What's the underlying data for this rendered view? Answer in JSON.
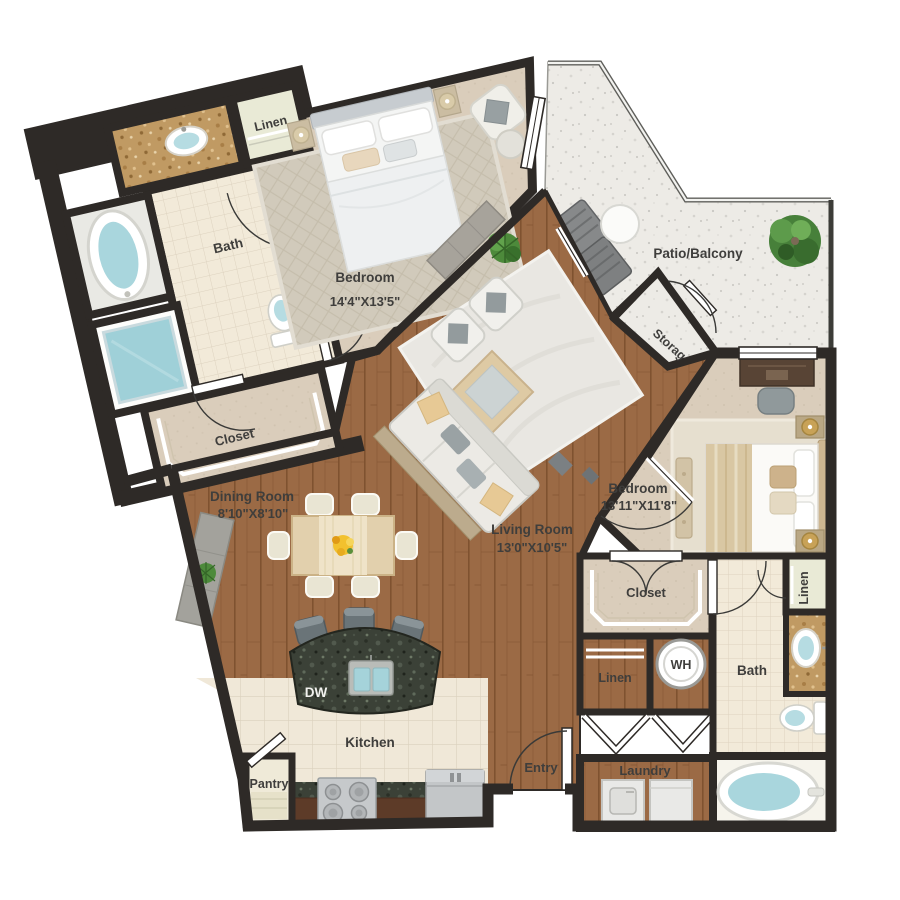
{
  "plan": {
    "title": "Two bedroom apartment floor plan",
    "rooms": {
      "bedroom1": {
        "name": "Bedroom",
        "dims": "14'4\"X13'5\""
      },
      "bedroom2": {
        "name": "Bedroom",
        "dims": "13'11\"X11'8\""
      },
      "living": {
        "name": "Living Room",
        "dims": "13'0\"X10'5\""
      },
      "dining": {
        "name": "Dining Room",
        "dims": "8'10\"X8'10\""
      },
      "kitchen": {
        "name": "Kitchen"
      },
      "bath1": {
        "name": "Bath"
      },
      "bath2": {
        "name": "Bath"
      },
      "closet1": {
        "name": "Closet"
      },
      "closet2": {
        "name": "Closet"
      },
      "linen1": {
        "name": "Linen"
      },
      "linen2": {
        "name": "Linen"
      },
      "linen3": {
        "name": "Linen"
      },
      "pantry": {
        "name": "Pantry"
      },
      "entry": {
        "name": "Entry"
      },
      "laundry": {
        "name": "Laundry"
      },
      "storage": {
        "name": "Storage"
      },
      "patio": {
        "name": "Patio/Balcony"
      }
    },
    "appliances": {
      "dishwasher": "DW",
      "water_heater": "WH"
    },
    "palette": {
      "wall": "#2e2a27",
      "wood_floor": "#9b6a45",
      "carpet": "#dacdbb",
      "tile": "#f2ead9",
      "patio_concrete": "#edebe6",
      "water": "#a9d6dd",
      "granite_dark": "#3b4137",
      "granite_tan": "#c09a63",
      "label_text": "#3f3e3c"
    }
  }
}
